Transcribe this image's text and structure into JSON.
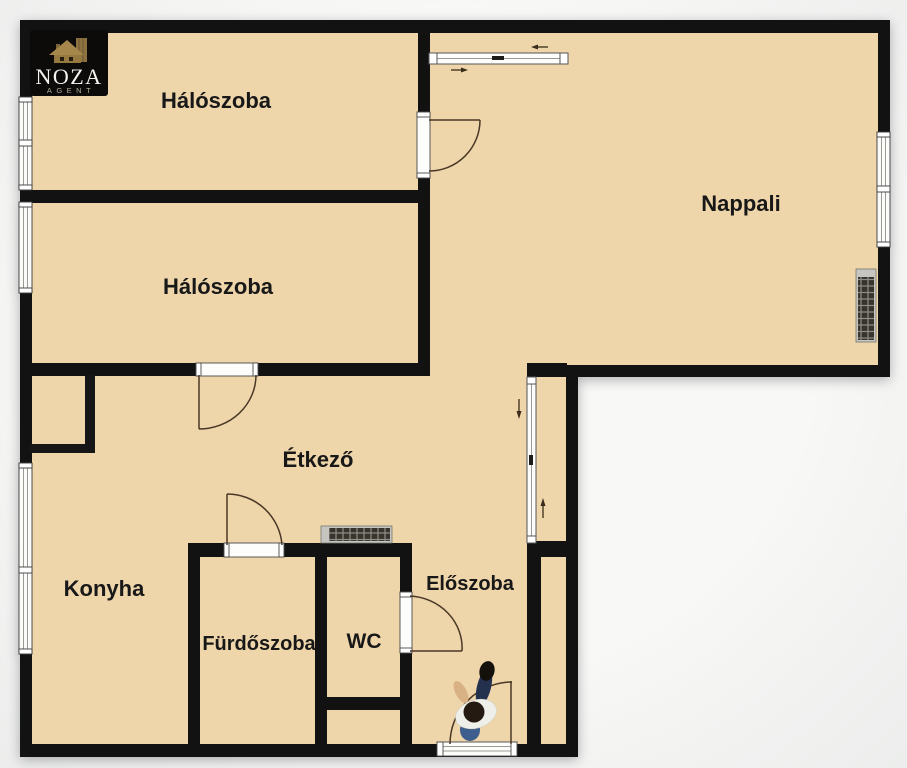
{
  "meta": {
    "type": "floor-plan"
  },
  "logo": {
    "brand": "NOZA",
    "subtitle": "AGENT"
  },
  "labels": {
    "bedroom1": "Hálószoba",
    "bedroom2": "Hálószoba",
    "living": "Nappali",
    "dining": "Étkező",
    "kitchen": "Konyha",
    "bathroom": "Fürdőszoba",
    "wc": "WC",
    "hall": "Előszoba"
  },
  "colors": {
    "floor": "#eed5aa",
    "wall": "#121212",
    "background": "#f7f7f5",
    "door_arc": "#4a3826",
    "logo_gold": "#a5874b",
    "logo_bg": "#0c0b09"
  }
}
